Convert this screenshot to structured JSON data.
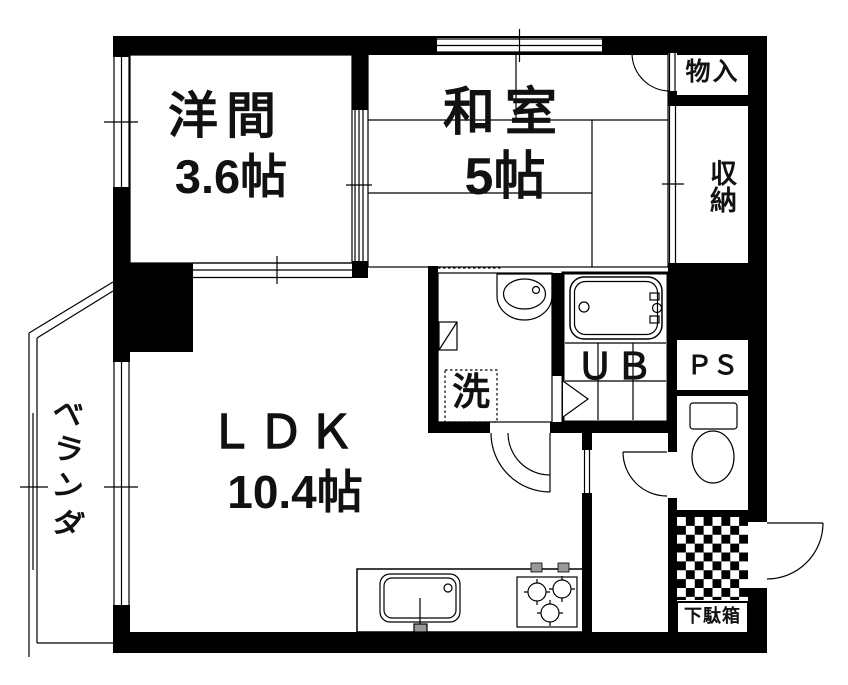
{
  "rooms": {
    "western": {
      "name": "洋間",
      "size": "3.6帖"
    },
    "japanese": {
      "name": "和室",
      "size": "5帖"
    },
    "ldk": {
      "name": "ＬＤＫ",
      "size": "10.4帖"
    },
    "storage": "物入",
    "closet": "収納",
    "unit_bath": "ＵＢ",
    "pipe_space": "ＰＳ",
    "laundry": "洗",
    "shoe_cabinet": "下駄箱",
    "veranda": {
      "label": "ベランダ",
      "chars": [
        "ベ",
        "ラ",
        "ン",
        "ダ"
      ]
    }
  },
  "colors": {
    "wall": "#000000",
    "floor": "#ffffff",
    "knob": "#999999"
  }
}
